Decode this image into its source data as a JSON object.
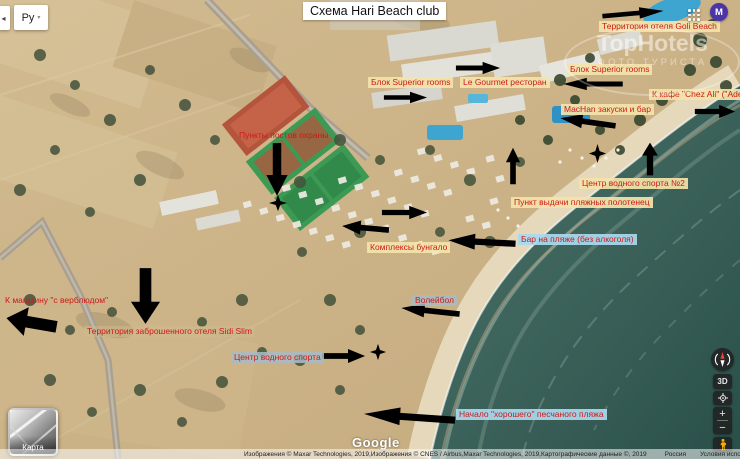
{
  "page": {
    "title": "Схема Hari Beach club"
  },
  "header": {
    "collapse_glyph": "◂",
    "language": {
      "label": "Ру",
      "caret": "▾"
    },
    "avatar_letter": "M"
  },
  "watermark": {
    "line1": "TopHotels",
    "line2": "ФОТО ТУРИСТА"
  },
  "annotations": {
    "labels": [
      {
        "text": "Территория отеля Goli Beach",
        "style": "yellow"
      },
      {
        "text": "Блок Superior rooms",
        "style": "yellow"
      },
      {
        "text": "Le Gourmet ресторан",
        "style": "yellow"
      },
      {
        "text": "Блок Superior rooms",
        "style": "yellow"
      },
      {
        "text": "К кафе \"Chez Ali\" (\"Adel\")",
        "style": "yellow"
      },
      {
        "text": "MacHan закуски и бар",
        "style": "yellow"
      },
      {
        "text": "Центр водного спорта №2",
        "style": "yellow"
      },
      {
        "text": "Пункт выдачи пляжных полотенец",
        "style": "yellow"
      },
      {
        "text": "Бар на пляже (без алкоголя)",
        "style": "blue"
      },
      {
        "text": "Пункты постов охраны",
        "style": "plain"
      },
      {
        "text": "Комплексы бунгало",
        "style": "yellow"
      },
      {
        "text": "К магазину \"с верблюдом\"",
        "style": "plain"
      },
      {
        "text": "Территория заброшенного отеля Sidi Slim",
        "style": "tan"
      },
      {
        "text": "Волейбол",
        "style": "gray"
      },
      {
        "text": "Центр водного спорта",
        "style": "gray"
      },
      {
        "text": "Начало \"хорошего\" песчаного пляжа",
        "style": "blue"
      }
    ],
    "accent_color": "#e01010"
  },
  "icons": {
    "apps": "grid-3x3-dots",
    "compass": "compass-needle",
    "my_location": "target-dot",
    "pegman": "street-view-person",
    "arrows": "hollow-red-arrows",
    "star_marker": "four-point-star"
  },
  "controls": {
    "map_3d": "3D",
    "zoom_in": "+",
    "zoom_out": "−",
    "map_toggle": "Карта"
  },
  "footer": {
    "google": "Google",
    "copyright": "Изображения © Maxar Technologies, 2019,Изображения © CNES / Airbus,Maxar Technologies, 2019,Картографические данные ©, 2019",
    "country": "Россия",
    "terms": "Условия использования",
    "feedback": "Оставить отзыв",
    "scale": "20 м"
  }
}
